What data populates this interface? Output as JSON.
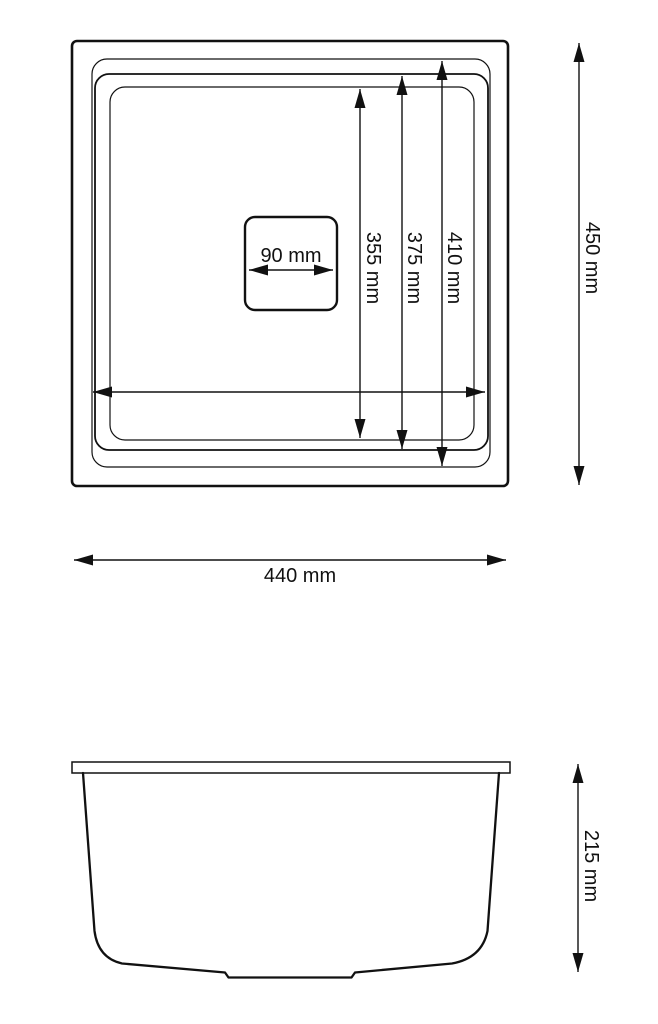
{
  "colors": {
    "ink": "#111111",
    "background": "#ffffff"
  },
  "views": {
    "top": {
      "description": "sink top view",
      "dim_drain_width": "90 mm",
      "dim_inner_bowl_depth": "355 mm",
      "dim_mid_rim_depth": "375 mm",
      "dim_outer_rim_depth": "410 mm",
      "dim_overall_depth": "450 mm",
      "dim_overall_width": "440 mm"
    },
    "side": {
      "description": "sink side profile view",
      "dim_overall_height": "215 mm"
    }
  }
}
